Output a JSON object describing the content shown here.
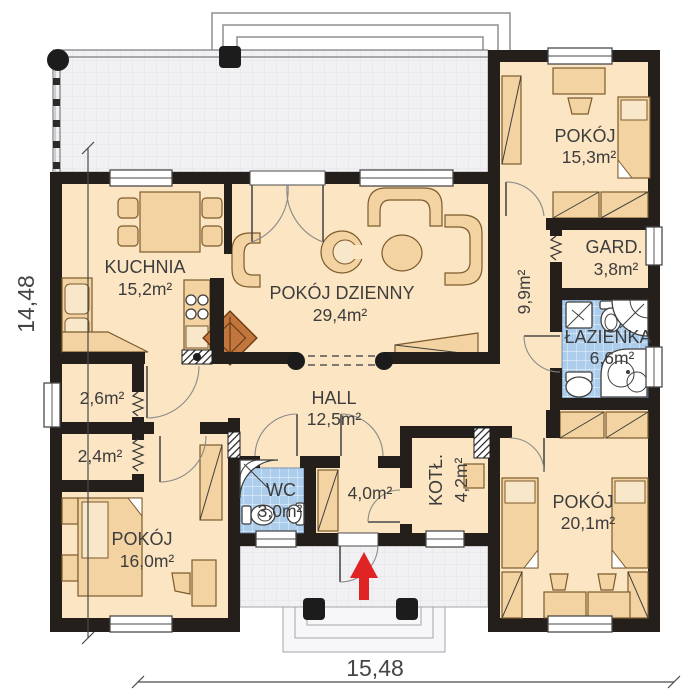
{
  "plan": {
    "type": "architectural-floor-plan",
    "dimensions": {
      "width_total": "15,48",
      "height_total": "14,48"
    },
    "rooms": {
      "kuchnia": {
        "name": "KUCHNIA",
        "area": "15,2m²"
      },
      "pokoj_dzienny": {
        "name": "POKÓJ DZIENNY",
        "area": "29,4m²"
      },
      "hall": {
        "name": "HALL",
        "area": "12,5m²"
      },
      "wc": {
        "name": "WC",
        "area": "3,0m²"
      },
      "pokoj_16": {
        "name": "POKÓJ",
        "area": "16,0m²"
      },
      "pokoj_15": {
        "name": "POKÓJ",
        "area": "15,3m²"
      },
      "pokoj_20": {
        "name": "POKÓJ",
        "area": "20,1m²"
      },
      "garderoba": {
        "name": "GARD.",
        "area": "3,8m²"
      },
      "lazienka": {
        "name": "ŁAZIENKA",
        "area": "6,6m²"
      },
      "kotlownia": {
        "name": "KOTŁ.",
        "area": "4,2m²"
      },
      "korytarz": {
        "area": "9,9m²"
      },
      "schowek_gorny": {
        "area": "2,6m²"
      },
      "schowek_dolny": {
        "area": "2,4m²"
      },
      "wiatrolap": {
        "area": "4,0m²"
      }
    },
    "colors": {
      "wall": "#241f1a",
      "floor": "#fce5c2",
      "furniture": "#f2d3a1",
      "tile_blue": "#accdeb",
      "terrace_grey": "#f1f1f3",
      "entrance_arrow": "#e02424",
      "fireplace": "#c0763c"
    }
  }
}
